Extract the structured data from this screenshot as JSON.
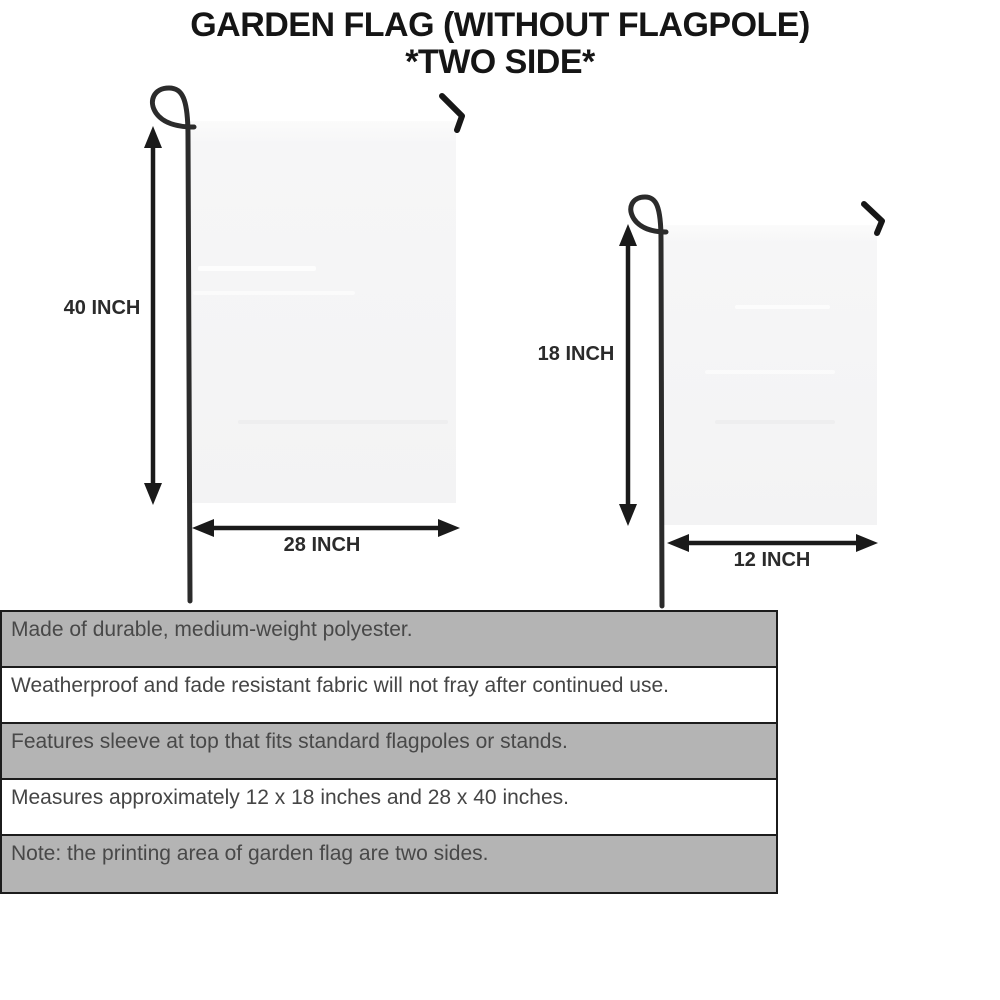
{
  "title": {
    "line1": "GARDEN FLAG (WITHOUT FLAGPOLE)",
    "line2": "*TWO SIDE*"
  },
  "flags": {
    "large": {
      "height_label": "40 INCH",
      "width_label": "28 INCH"
    },
    "small": {
      "height_label": "18 INCH",
      "width_label": "12 INCH"
    }
  },
  "features": [
    {
      "text": "Made of durable, medium-weight polyester."
    },
    {
      "text": "Weatherproof and fade resistant fabric will not fray after continued use."
    },
    {
      "text": "Features sleeve at top that fits standard flagpoles or stands."
    },
    {
      "text": "Measures approximately 12 x 18 inches and 28 x 40 inches."
    },
    {
      "text": "Note: the printing area of garden flag are two sides."
    }
  ],
  "colors": {
    "ink": "#1a1a1a",
    "pole": "#2b2b2b",
    "flag_fill": "#f5f5f6",
    "row_shade": "#b4b4b4",
    "background": "#ffffff"
  }
}
